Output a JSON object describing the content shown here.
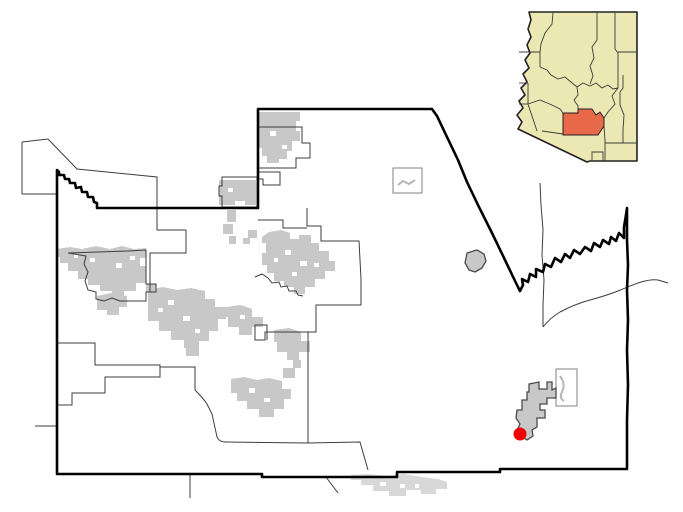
{
  "map": {
    "description": "county-locator-map",
    "colors": {
      "background": "#ffffff",
      "county_border": "#000000",
      "boundary_line": "#3d3d3d",
      "incorporated_fill": "#c8c8c8",
      "incorporated_outline": "#5f5f5f",
      "outside_area_fill": "#d8d8d8",
      "box_outline": "#808080",
      "stream_light": "#b5b5b5"
    },
    "marker": {
      "cx": 520,
      "cy": 434,
      "r": 6.5,
      "fill": "#ee0000"
    }
  },
  "inset": {
    "colors": {
      "state_fill": "#ece8b4",
      "state_border": "#222222",
      "county_line": "#3a3a3a",
      "highlight_fill": "#e8684a"
    }
  }
}
